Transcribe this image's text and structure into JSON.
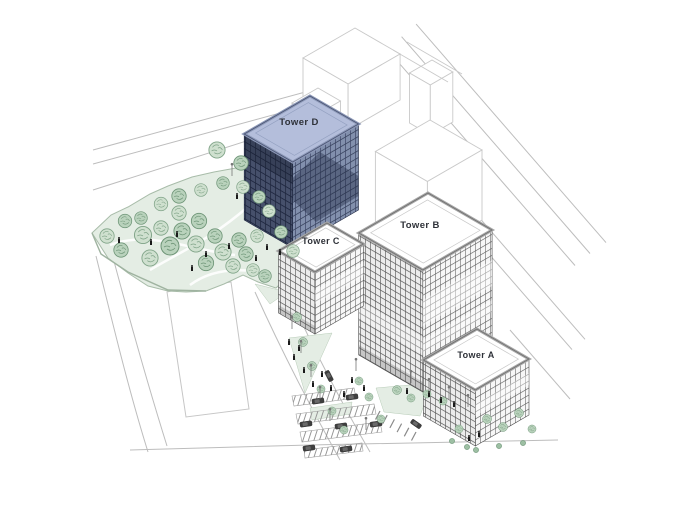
{
  "illustration": {
    "type": "axonometric-site-plan",
    "towers": [
      {
        "id": "a",
        "label": "Tower A"
      },
      {
        "id": "b",
        "label": "Tower B"
      },
      {
        "id": "c",
        "label": "Tower C"
      },
      {
        "id": "d",
        "label": "Tower D"
      }
    ]
  },
  "colors": {
    "background": "#ffffff",
    "tower_d_roof": "#b4bedb",
    "tower_d_face_left": "#46506b",
    "tower_d_face_right": "#8290ad",
    "tower_white_face": "#f0f0f0",
    "facade_grid_line": "#5f5f5f",
    "roof_white": "#ffffff",
    "parapet_band": "#a8a8a8",
    "park_ground": "#e4ede4",
    "tree_fill_light": "#cfe0cf",
    "tree_fill_dark": "#b9d2bc",
    "tree_stroke": "#7fa387",
    "road_line": "#bdbdbd",
    "context_building_outline": "#c9c9c9",
    "label_text": "#2e3138",
    "person": "#1a1a1a",
    "car": "#3f3f3f",
    "lamp": "#777777"
  }
}
